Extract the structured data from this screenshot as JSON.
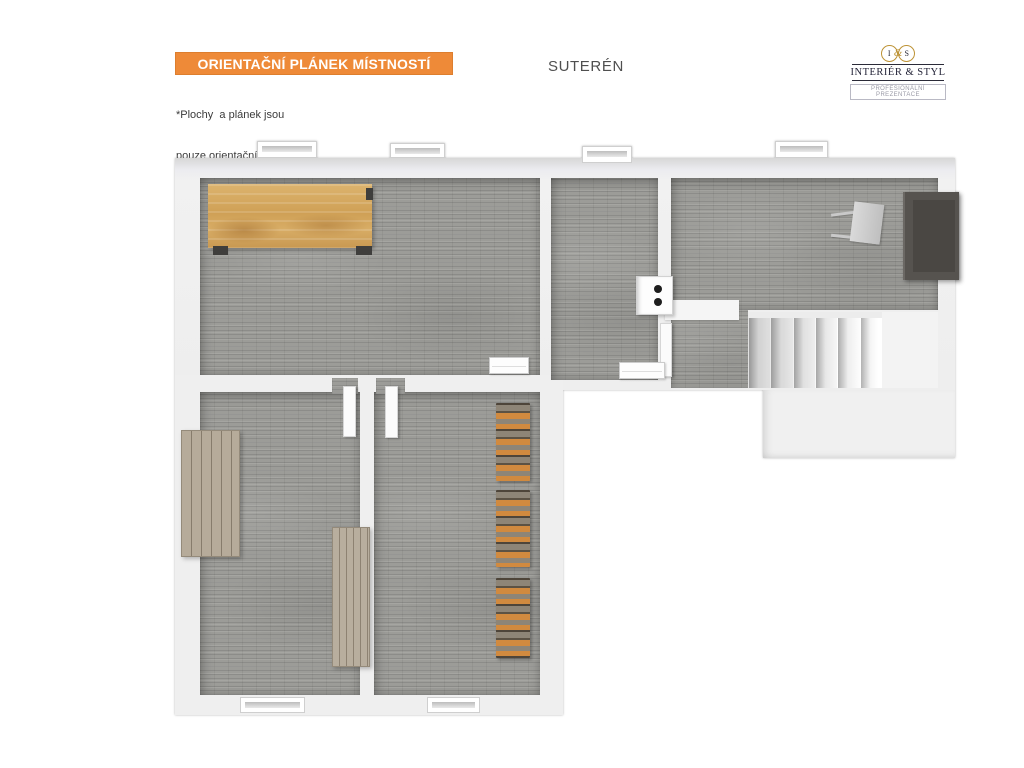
{
  "header": {
    "plan_title": "ORIENTAČNÍ PLÁNEK MÍSTNOSTÍ",
    "disclaimer_line1": "*Plochy  a plánek jsou",
    "disclaimer_line2": "pouze orientační",
    "floor_label": "SUTERÉN"
  },
  "logo": {
    "monogram_left": "I",
    "monogram_amp": "&",
    "monogram_right": "S",
    "company_name": "INTERIÉR & STYL",
    "tagline": "PROFESIONÁLNÍ PREZENTACE"
  },
  "colors": {
    "banner_orange": "#EE8A38",
    "banner_border": "#DD7E2E",
    "banner_text": "#FFFFFF",
    "floor_label_gray": "#4F4F4F",
    "floor_brick_gray": "#9C9C98",
    "wall_white": "#EFEFEF",
    "wood_table": "#D2A563",
    "wood_cabinet_gray": "#B2A796",
    "dark_cabinet": "#56534F",
    "firewood_orange": "#D18A3F",
    "logo_gold": "#BD9336",
    "logo_text": "#26263A"
  }
}
